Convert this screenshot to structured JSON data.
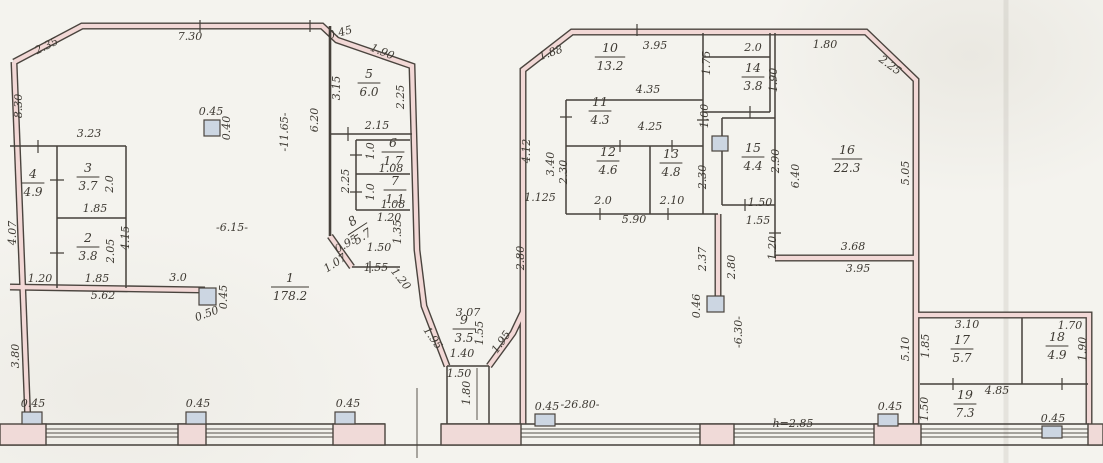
{
  "annotations": {
    "height_note": "h=2.85",
    "overall_width_note": "-26.80-",
    "hall_depth_note": "-11.65-",
    "hall_width_note": "-6.15-",
    "gap_note": "-6.30-",
    "accent_blue": "#3552b8",
    "wall_fill_pink": "#f2d8d6",
    "column_fill": "#ccd6e2"
  },
  "rooms": [
    {
      "n": "1",
      "a": "178.2",
      "x": 290,
      "y": 286
    },
    {
      "n": "2",
      "a": "3.8",
      "x": 88,
      "y": 246
    },
    {
      "n": "3",
      "a": "3.7",
      "x": 88,
      "y": 176
    },
    {
      "n": "4",
      "a": "4.9",
      "x": 33,
      "y": 182
    },
    {
      "n": "5",
      "a": "6.0",
      "x": 369,
      "y": 82
    },
    {
      "n": "6",
      "a": "1.7",
      "x": 393,
      "y": 151
    },
    {
      "n": "7",
      "a": "1.1",
      "x": 395,
      "y": 189
    },
    {
      "n": "8",
      "a": "5.7",
      "x": 357,
      "y": 228,
      "r": -33
    },
    {
      "n": "9",
      "a": "3.5",
      "x": 464,
      "y": 328
    },
    {
      "n": "10",
      "a": "13.2",
      "x": 610,
      "y": 56
    },
    {
      "n": "11",
      "a": "4.3",
      "x": 600,
      "y": 110
    },
    {
      "n": "12",
      "a": "4.6",
      "x": 608,
      "y": 160
    },
    {
      "n": "13",
      "a": "4.8",
      "x": 671,
      "y": 162
    },
    {
      "n": "14",
      "a": "3.8",
      "x": 753,
      "y": 76
    },
    {
      "n": "15",
      "a": "4.4",
      "x": 753,
      "y": 156
    },
    {
      "n": "16",
      "a": "22.3",
      "x": 847,
      "y": 158
    },
    {
      "n": "17",
      "a": "5.7",
      "x": 962,
      "y": 348
    },
    {
      "n": "18",
      "a": "4.9",
      "x": 1057,
      "y": 345
    },
    {
      "n": "19",
      "a": "7.3",
      "x": 965,
      "y": 403
    }
  ],
  "labels": [
    {
      "t": "2.35",
      "x": 48,
      "y": 49,
      "r": -26
    },
    {
      "t": "7.30",
      "x": 190,
      "y": 40
    },
    {
      "t": "8.30",
      "x": 22,
      "y": 106,
      "r": -90
    },
    {
      "t": "0.45",
      "x": 341,
      "y": 36,
      "r": -15,
      "s": 10
    },
    {
      "t": "1.90",
      "x": 381,
      "y": 55,
      "r": 22
    },
    {
      "t": "3.15",
      "x": 340,
      "y": 88,
      "r": -90
    },
    {
      "t": "2.25",
      "x": 404,
      "y": 97,
      "r": -90
    },
    {
      "t": "6.20",
      "x": 318,
      "y": 120,
      "r": -90
    },
    {
      "t": "-11.65-",
      "x": 288,
      "y": 132,
      "r": -90,
      "s": 12
    },
    {
      "t": "2.15",
      "x": 377,
      "y": 129
    },
    {
      "t": "1.0",
      "x": 374,
      "y": 151,
      "r": -90,
      "s": 10
    },
    {
      "t": "1.08",
      "x": 391,
      "y": 172,
      "s": 10
    },
    {
      "t": "2.25",
      "x": 349,
      "y": 181,
      "r": -90
    },
    {
      "t": "1.0",
      "x": 374,
      "y": 192,
      "r": -90,
      "s": 10
    },
    {
      "t": "1.08",
      "x": 393,
      "y": 208,
      "s": 10
    },
    {
      "t": "1.20",
      "x": 389,
      "y": 221,
      "s": 10
    },
    {
      "t": "1.35",
      "x": 401,
      "y": 232,
      "r": -90,
      "s": 10
    },
    {
      "t": "0.95",
      "x": 348,
      "y": 247,
      "r": -30
    },
    {
      "t": "1.07",
      "x": 337,
      "y": 266,
      "r": -33
    },
    {
      "t": "1.50",
      "x": 379,
      "y": 251,
      "s": 10
    },
    {
      "t": "1.55",
      "x": 376,
      "y": 271,
      "s": 10
    },
    {
      "t": "1.20",
      "x": 398,
      "y": 281,
      "r": 52,
      "s": 10
    },
    {
      "t": "3.23",
      "x": 89,
      "y": 137
    },
    {
      "t": "2.0",
      "x": 113,
      "y": 184,
      "r": -90,
      "s": 10
    },
    {
      "t": "1.85",
      "x": 95,
      "y": 212
    },
    {
      "t": "4.07",
      "x": 16,
      "y": 233,
      "r": -90
    },
    {
      "t": "4.15",
      "x": 129,
      "y": 238,
      "r": -90
    },
    {
      "t": "2.05",
      "x": 114,
      "y": 251,
      "r": -90,
      "s": 10
    },
    {
      "t": "1.20",
      "x": 40,
      "y": 282
    },
    {
      "t": "1.85",
      "x": 97,
      "y": 282
    },
    {
      "t": "3.0",
      "x": 178,
      "y": 281
    },
    {
      "t": "5.62",
      "x": 103,
      "y": 299
    },
    {
      "t": "3.80",
      "x": 19,
      "y": 356,
      "r": -90
    },
    {
      "t": "-6.15-",
      "x": 232,
      "y": 231,
      "s": 13
    },
    {
      "t": "0.45",
      "x": 211,
      "y": 115,
      "s": 10
    },
    {
      "t": "0.40",
      "x": 230,
      "y": 128,
      "r": -90,
      "s": 10
    },
    {
      "t": "0.45",
      "x": 227,
      "y": 297,
      "r": -90,
      "s": 10
    },
    {
      "t": "0.50",
      "x": 208,
      "y": 317,
      "r": -20,
      "s": 10
    },
    {
      "t": "3.07",
      "x": 468,
      "y": 316,
      "s": 10
    },
    {
      "t": "1.55",
      "x": 483,
      "y": 333,
      "r": -90,
      "s": 10
    },
    {
      "t": "1.40",
      "x": 462,
      "y": 357,
      "s": 10
    },
    {
      "t": "1.50",
      "x": 459,
      "y": 377,
      "s": 10
    },
    {
      "t": "1.80",
      "x": 470,
      "y": 393,
      "r": -90,
      "s": 10
    },
    {
      "t": "1.95",
      "x": 430,
      "y": 340,
      "r": 55
    },
    {
      "t": "1.95",
      "x": 504,
      "y": 344,
      "r": -55
    },
    {
      "t": "2.80",
      "x": 524,
      "y": 258,
      "r": -90
    },
    {
      "t": "1.88",
      "x": 552,
      "y": 56,
      "r": -20
    },
    {
      "t": "3.95",
      "x": 655,
      "y": 49
    },
    {
      "t": "2.0",
      "x": 753,
      "y": 51
    },
    {
      "t": "1.80",
      "x": 825,
      "y": 48
    },
    {
      "t": "2.25",
      "x": 888,
      "y": 68,
      "r": 36
    },
    {
      "t": "1.75",
      "x": 710,
      "y": 63,
      "r": -90,
      "s": 10
    },
    {
      "t": "1.90",
      "x": 777,
      "y": 80,
      "r": -90,
      "s": 10
    },
    {
      "t": "4.35",
      "x": 648,
      "y": 93
    },
    {
      "t": "1.00",
      "x": 708,
      "y": 116,
      "r": -90,
      "s": 10
    },
    {
      "t": "4.25",
      "x": 650,
      "y": 130
    },
    {
      "t": "4.12",
      "x": 530,
      "y": 151,
      "r": -90
    },
    {
      "t": "3.40",
      "x": 554,
      "y": 164,
      "r": -90,
      "s": 10
    },
    {
      "t": "2.30",
      "x": 567,
      "y": 172,
      "r": -90,
      "s": 10
    },
    {
      "t": "2.30",
      "x": 706,
      "y": 177,
      "r": -90,
      "s": 10
    },
    {
      "t": "1.125",
      "x": 540,
      "y": 201,
      "s": 10
    },
    {
      "t": "2.0",
      "x": 603,
      "y": 204
    },
    {
      "t": "2.10",
      "x": 672,
      "y": 204
    },
    {
      "t": "5.90",
      "x": 634,
      "y": 223
    },
    {
      "t": "2.90",
      "x": 779,
      "y": 161,
      "r": -90,
      "s": 10
    },
    {
      "t": "6.40",
      "x": 799,
      "y": 176,
      "r": -90
    },
    {
      "t": "1.50",
      "x": 760,
      "y": 206,
      "s": 10
    },
    {
      "t": "1.55",
      "x": 758,
      "y": 224,
      "s": 10
    },
    {
      "t": "1.20",
      "x": 776,
      "y": 248,
      "r": -90,
      "s": 10
    },
    {
      "t": "5.05",
      "x": 909,
      "y": 173,
      "r": -90
    },
    {
      "t": "3.68",
      "x": 853,
      "y": 250
    },
    {
      "t": "3.95",
      "x": 858,
      "y": 272
    },
    {
      "t": "2.37",
      "x": 706,
      "y": 259,
      "r": -90,
      "s": 10
    },
    {
      "t": "2.80",
      "x": 735,
      "y": 267,
      "r": -90
    },
    {
      "t": "0.46",
      "x": 700,
      "y": 306,
      "r": -90,
      "s": 10
    },
    {
      "t": "-6.30-",
      "x": 742,
      "y": 332,
      "r": -90,
      "s": 13
    },
    {
      "t": "5.10",
      "x": 909,
      "y": 349,
      "r": -90
    },
    {
      "t": "3.10",
      "x": 967,
      "y": 328
    },
    {
      "t": "1.70",
      "x": 1070,
      "y": 329
    },
    {
      "t": "1.85",
      "x": 929,
      "y": 346,
      "r": -90,
      "s": 10
    },
    {
      "t": "1.90",
      "x": 1086,
      "y": 349,
      "r": -90,
      "s": 10
    },
    {
      "t": "4.85",
      "x": 997,
      "y": 394
    },
    {
      "t": "1.50",
      "x": 928,
      "y": 409,
      "r": -90,
      "s": 10
    },
    {
      "t": "0.45",
      "x": 33,
      "y": 407,
      "s": 10
    },
    {
      "t": "0.45",
      "x": 198,
      "y": 407,
      "s": 10
    },
    {
      "t": "0.45",
      "x": 348,
      "y": 407,
      "s": 10
    },
    {
      "t": "0.45",
      "x": 547,
      "y": 410,
      "s": 10
    },
    {
      "t": "0.45",
      "x": 890,
      "y": 410,
      "s": 10
    },
    {
      "t": "0.45",
      "x": 1053,
      "y": 422,
      "s": 10
    },
    {
      "t": "-26.80-",
      "x": 580,
      "y": 408,
      "s": 13
    },
    {
      "t": "h=2.85",
      "x": 793,
      "y": 427,
      "s": 14,
      "c": "#3552b8"
    }
  ]
}
